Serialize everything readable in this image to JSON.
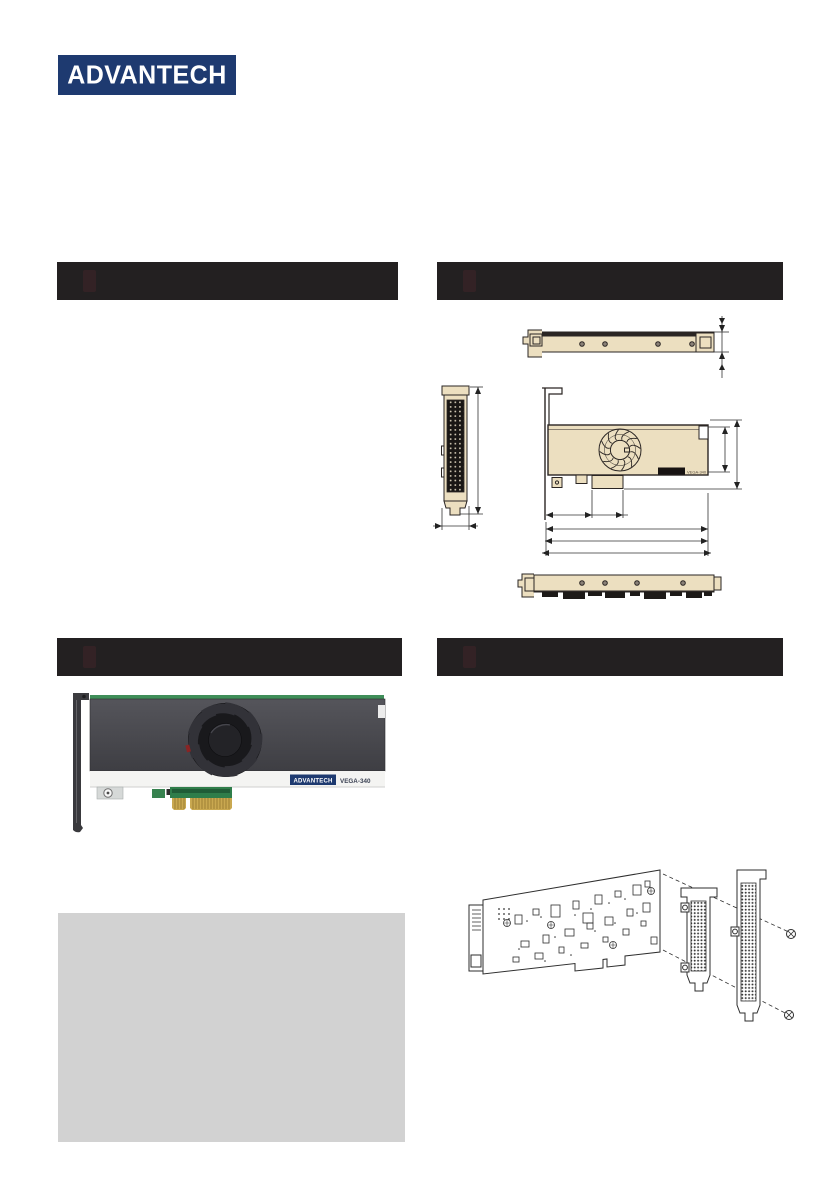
{
  "page": {
    "background": "#ffffff"
  },
  "header": {
    "logo_text": "ADVANTECH",
    "logo_bg": "#1e3a70",
    "logo_fg": "#ffffff"
  },
  "section_bars": {
    "color": "#232021",
    "items": [
      {
        "position": "top-left",
        "label": ""
      },
      {
        "position": "top-right",
        "label": ""
      },
      {
        "position": "middle-left",
        "label": ""
      },
      {
        "position": "middle-right",
        "label": ""
      }
    ]
  },
  "dimensions_figure": {
    "model_label": "VEGA-340",
    "board_fill": "#ecdfc0",
    "line_color": "#2a2523",
    "views": [
      "top-side-view",
      "bracket-front-view",
      "board-front-view-with-fan",
      "bottom-side-view"
    ]
  },
  "product_photo": {
    "brand_label": "ADVANTECH",
    "model_label": "VEGA-340",
    "brand_bg": "#1e3a70",
    "shroud_color": "#48484c",
    "fan_color": "#19191c",
    "pcb_color": "#3f8e59",
    "gold_color": "#c9a850",
    "strip_color": "#f4f4f2",
    "bracket_color": "#3c3c40"
  },
  "assembly_figure": {
    "parts": [
      "pcb-back-side",
      "low-profile-bracket",
      "full-height-bracket",
      "screw",
      "screw"
    ]
  },
  "placeholder_box": {
    "fill": "#d2d2d2"
  }
}
